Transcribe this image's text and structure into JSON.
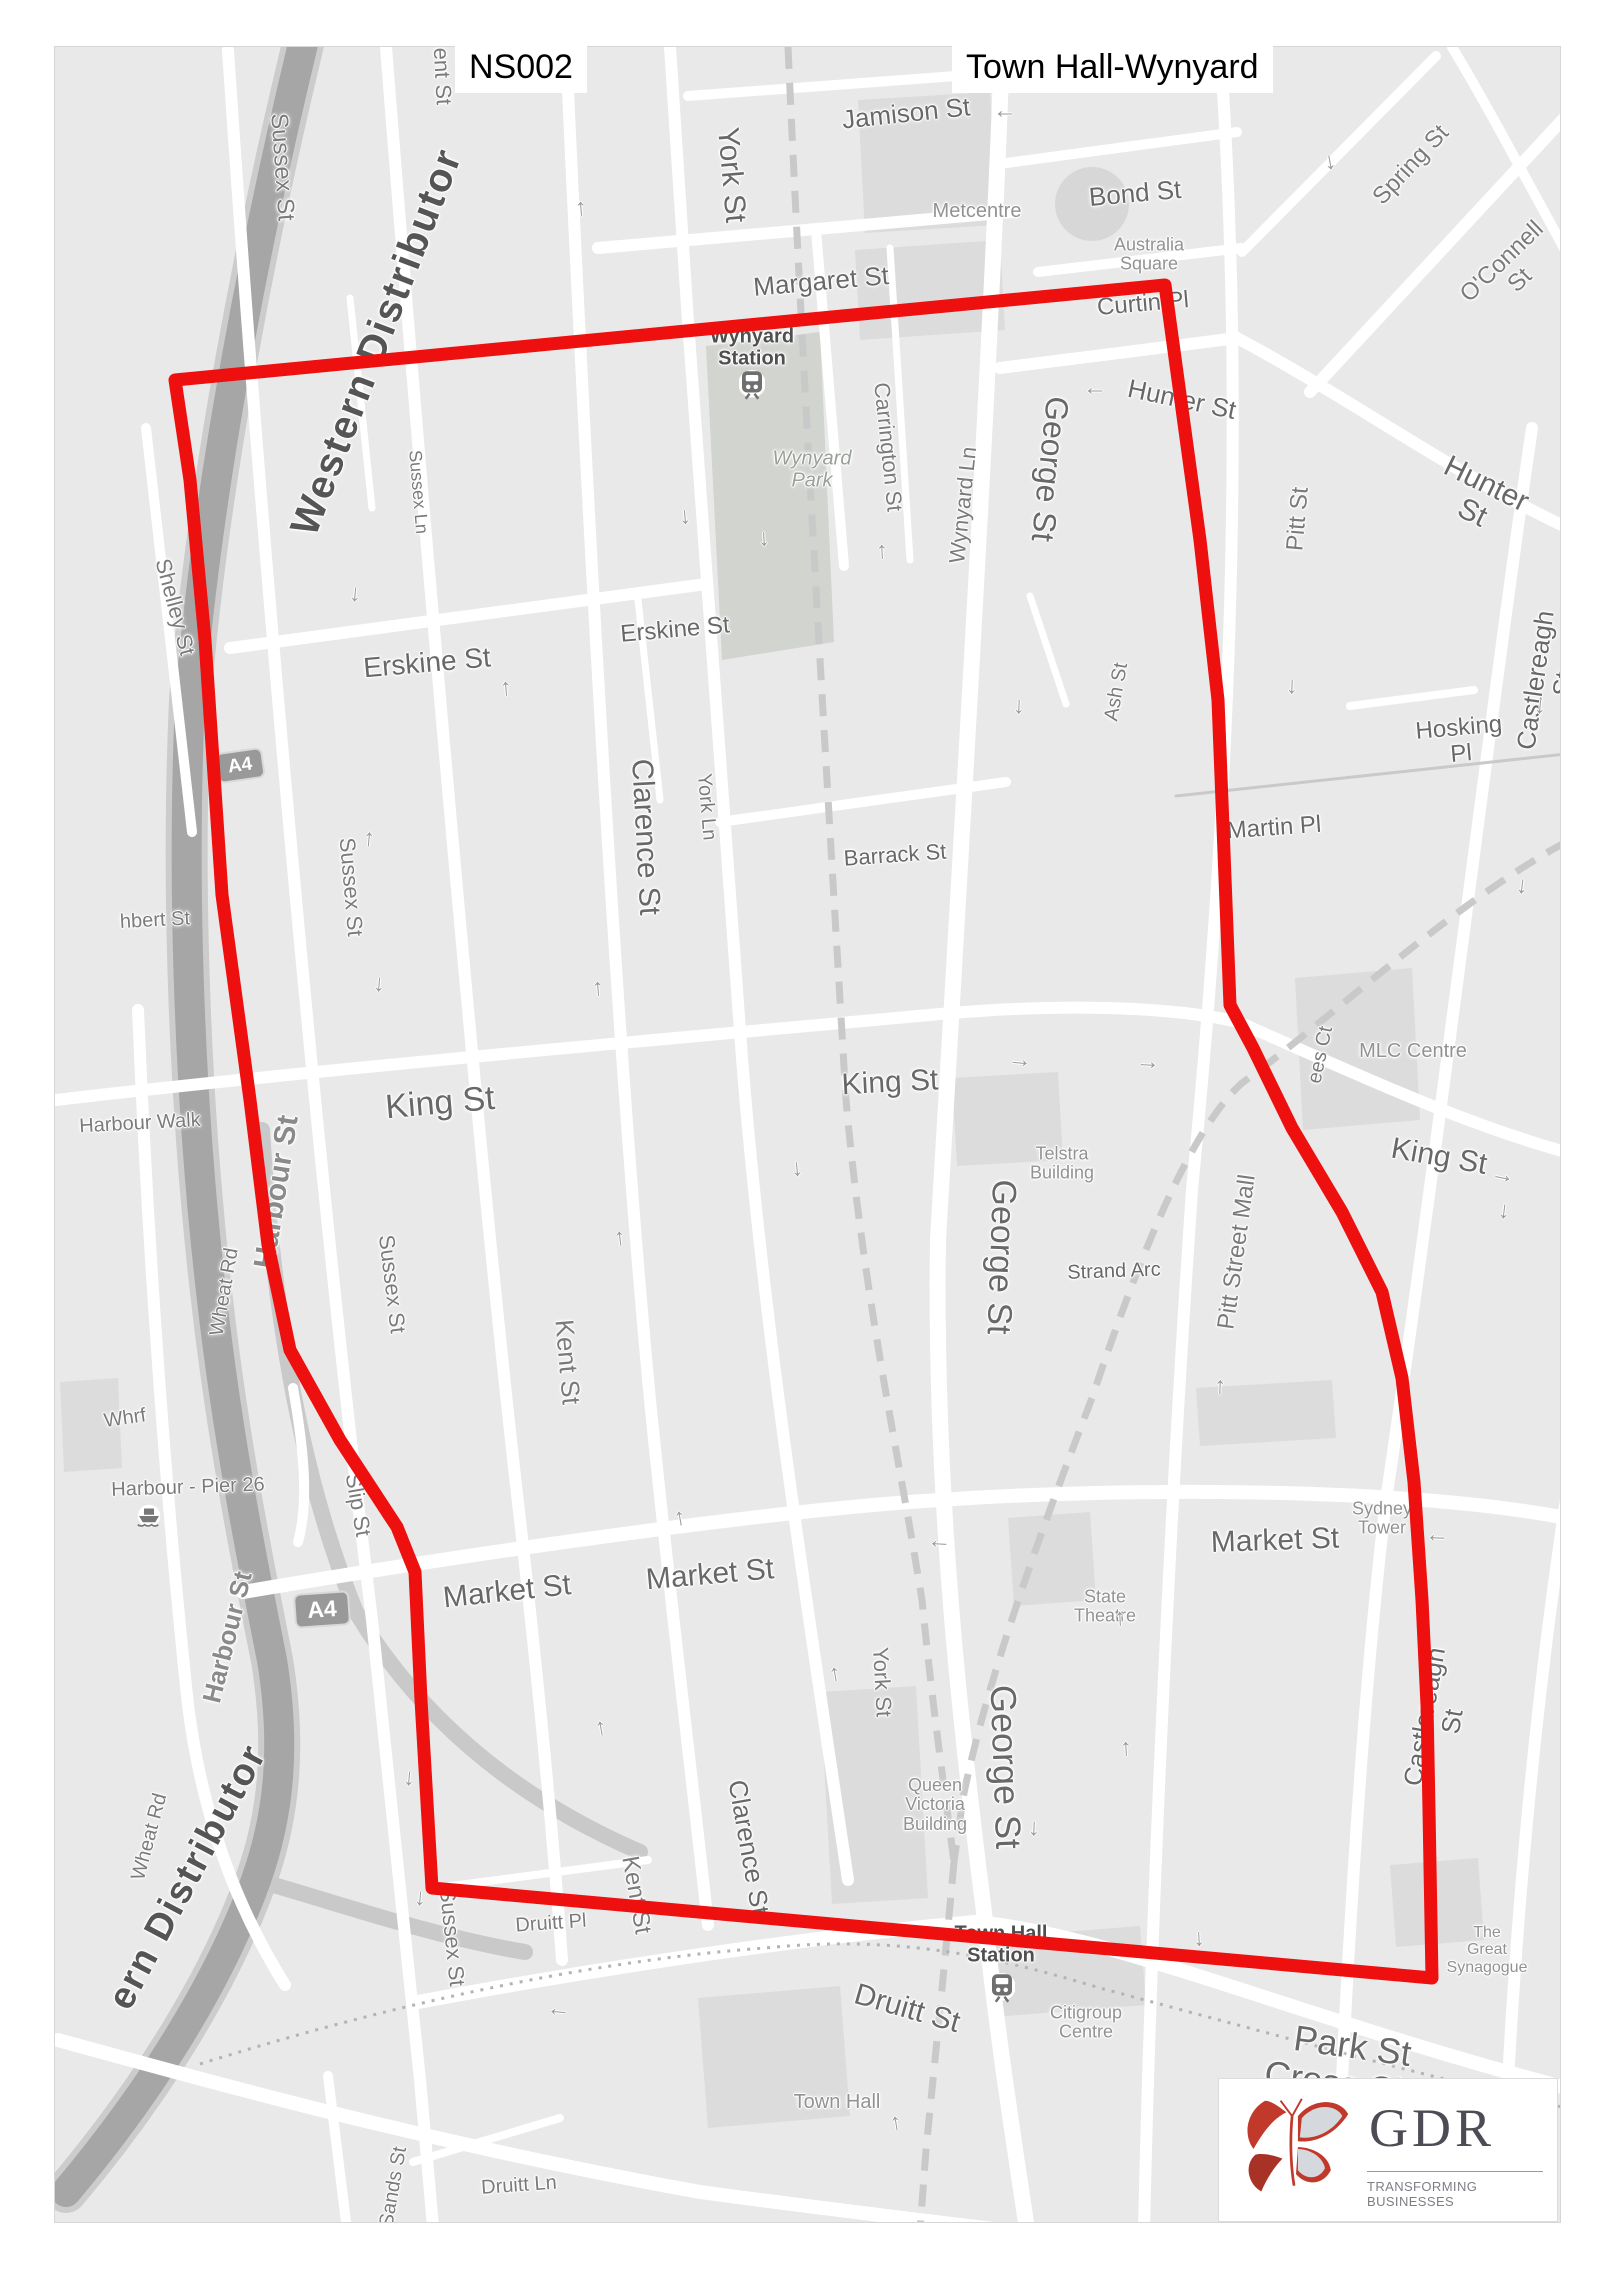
{
  "title": {
    "left": "NS002",
    "right": "Town Hall-Wynyard"
  },
  "logo": {
    "name": "GDR",
    "tagline": "TRANSFORMING BUSINESSES"
  },
  "red_zone": {
    "color": "#ee0f0f",
    "width": 13,
    "points": "175,380 1165,285 1200,540 1218,700 1230,1005 1253,1048 1292,1128 1342,1212 1382,1292 1402,1378 1414,1482 1422,1600 1427,1705 1429,1810 1432,1978 432,1888 421,1700 415,1572 397,1527 340,1440 290,1350 268,1245 250,1100 235,990 222,895 205,640 190,480"
  },
  "map": {
    "arrow_glyph": "→",
    "labels": [
      {
        "t": "Sussex St",
        "x": 227,
        "y": 120,
        "r": 86,
        "s": 24,
        "c": "st"
      },
      {
        "t": "Kent St",
        "x": 387,
        "y": 22,
        "r": 87,
        "s": 22,
        "c": "st"
      },
      {
        "t": "York St",
        "x": 676,
        "y": 128,
        "r": 85,
        "s": 30,
        "c": "st2"
      },
      {
        "t": "Jamison St",
        "x": 851,
        "y": 66,
        "r": -6,
        "s": 26,
        "c": "st2"
      },
      {
        "t": "Bond St",
        "x": 1080,
        "y": 146,
        "r": -5,
        "s": 26,
        "c": "st2"
      },
      {
        "t": "Spring St",
        "x": 1356,
        "y": 118,
        "r": -47,
        "s": 24,
        "c": "st"
      },
      {
        "t": "O'Connell St",
        "x": 1456,
        "y": 224,
        "r": -44,
        "s": 24,
        "c": "st"
      },
      {
        "t": "Metcentre",
        "x": 922,
        "y": 165,
        "r": 0,
        "s": 20,
        "c": "bld"
      },
      {
        "t": "Australia\nSquare",
        "x": 1094,
        "y": 208,
        "r": 0,
        "s": 18,
        "c": "bld"
      },
      {
        "t": "Margaret St",
        "x": 766,
        "y": 234,
        "r": -5,
        "s": 26,
        "c": "st2"
      },
      {
        "t": "Curtin Pl",
        "x": 1088,
        "y": 257,
        "r": -5,
        "s": 24,
        "c": "st2"
      },
      {
        "t": "Wynyard\nStation",
        "x": 697,
        "y": 301,
        "r": 0,
        "s": 20,
        "c": "sta"
      },
      {
        "t": "Hunter St",
        "x": 1127,
        "y": 352,
        "r": 12,
        "s": 26,
        "c": "st2"
      },
      {
        "t": "Hunter St",
        "x": 1424,
        "y": 452,
        "r": 26,
        "s": 30,
        "c": "st2"
      },
      {
        "t": "Carrington St",
        "x": 833,
        "y": 400,
        "r": 84,
        "s": 22,
        "c": "st"
      },
      {
        "t": "Wynyard Ln",
        "x": 908,
        "y": 458,
        "r": -84,
        "s": 22,
        "c": "st"
      },
      {
        "t": "Wynyard\nPark",
        "x": 757,
        "y": 423,
        "r": 0,
        "s": 20,
        "c": "park"
      },
      {
        "t": "George St",
        "x": 995,
        "y": 422,
        "r": 96,
        "s": 32,
        "c": "st2"
      },
      {
        "t": "Pitt St",
        "x": 1243,
        "y": 472,
        "r": -85,
        "s": 24,
        "c": "st"
      },
      {
        "t": "Sussex Ln",
        "x": 363,
        "y": 445,
        "r": 85,
        "s": 18,
        "c": "st"
      },
      {
        "t": "Shelley St",
        "x": 120,
        "y": 560,
        "r": 75,
        "s": 22,
        "c": "st"
      },
      {
        "t": "Erskine St",
        "x": 372,
        "y": 616,
        "r": -5,
        "s": 28,
        "c": "st2"
      },
      {
        "t": "Erskine St",
        "x": 620,
        "y": 583,
        "r": -5,
        "s": 24,
        "c": "st2"
      },
      {
        "t": "Ash St",
        "x": 1062,
        "y": 645,
        "r": -80,
        "s": 20,
        "c": "st"
      },
      {
        "t": "Hosking Pl",
        "x": 1405,
        "y": 694,
        "r": -5,
        "s": 24,
        "c": "st2"
      },
      {
        "t": "Castlereagh St",
        "x": 1494,
        "y": 635,
        "r": -82,
        "s": 26,
        "c": "st2"
      },
      {
        "t": "Martin Pl",
        "x": 1219,
        "y": 781,
        "r": -4,
        "s": 24,
        "c": "st2"
      },
      {
        "t": "Mar\nS",
        "x": 1553,
        "y": 786,
        "r": 0,
        "s": 20,
        "c": "st2"
      },
      {
        "t": "Western Distributor",
        "x": 322,
        "y": 295,
        "r": -69,
        "s": 40,
        "c": "mwy"
      },
      {
        "t": "hbert St",
        "x": 100,
        "y": 874,
        "r": -3,
        "s": 20,
        "c": "st"
      },
      {
        "t": "Sussex St",
        "x": 296,
        "y": 840,
        "r": 85,
        "s": 22,
        "c": "st"
      },
      {
        "t": "Clarence St",
        "x": 590,
        "y": 790,
        "r": 87,
        "s": 30,
        "c": "st2"
      },
      {
        "t": "York Ln",
        "x": 651,
        "y": 760,
        "r": 85,
        "s": 20,
        "c": "st"
      },
      {
        "t": "Barrack St",
        "x": 840,
        "y": 808,
        "r": -4,
        "s": 22,
        "c": "st2"
      },
      {
        "t": "King St",
        "x": 385,
        "y": 1056,
        "r": -5,
        "s": 34,
        "c": "st2"
      },
      {
        "t": "King St",
        "x": 835,
        "y": 1036,
        "r": -3,
        "s": 30,
        "c": "st2"
      },
      {
        "t": "King St",
        "x": 1384,
        "y": 1110,
        "r": 10,
        "s": 30,
        "c": "st2"
      },
      {
        "t": "ees Ct",
        "x": 1266,
        "y": 1008,
        "r": -78,
        "s": 20,
        "c": "st"
      },
      {
        "t": "MLC Centre",
        "x": 1358,
        "y": 1005,
        "r": 0,
        "s": 20,
        "c": "bld"
      },
      {
        "t": "Harbour Walk",
        "x": 85,
        "y": 1077,
        "r": -3,
        "s": 20,
        "c": "st"
      },
      {
        "t": "Telstra\nBuilding",
        "x": 1007,
        "y": 1117,
        "r": 0,
        "s": 18,
        "c": "bld"
      },
      {
        "t": "Pitt Street Mall",
        "x": 1182,
        "y": 1205,
        "r": -82,
        "s": 24,
        "c": "st"
      },
      {
        "t": "Strand Arc",
        "x": 1059,
        "y": 1225,
        "r": -2,
        "s": 20,
        "c": "st2"
      },
      {
        "t": "George St",
        "x": 946,
        "y": 1210,
        "r": 92,
        "s": 34,
        "c": "st2"
      },
      {
        "t": "Wheat Rd",
        "x": 170,
        "y": 1245,
        "r": -80,
        "s": 20,
        "c": "st"
      },
      {
        "t": "Harbour St",
        "x": 222,
        "y": 1145,
        "r": -81,
        "s": 30,
        "c": "sthalo"
      },
      {
        "t": "Kent St",
        "x": 513,
        "y": 1315,
        "r": 85,
        "s": 26,
        "c": "st"
      },
      {
        "t": "Sussex St",
        "x": 337,
        "y": 1237,
        "r": 83,
        "s": 22,
        "c": "st"
      },
      {
        "t": "Whrf",
        "x": 70,
        "y": 1372,
        "r": -8,
        "s": 20,
        "c": "st"
      },
      {
        "t": "Harbour - Pier 26",
        "x": 133,
        "y": 1441,
        "r": -2,
        "s": 20,
        "c": "st"
      },
      {
        "t": "Slip St",
        "x": 303,
        "y": 1458,
        "r": 80,
        "s": 22,
        "c": "st"
      },
      {
        "t": "Market St",
        "x": 452,
        "y": 1545,
        "r": -6,
        "s": 30,
        "c": "st2"
      },
      {
        "t": "Market St",
        "x": 655,
        "y": 1528,
        "r": -5,
        "s": 30,
        "c": "st2"
      },
      {
        "t": "Market St",
        "x": 1220,
        "y": 1494,
        "r": -2,
        "s": 30,
        "c": "st2"
      },
      {
        "t": "Sydney\nTower",
        "x": 1327,
        "y": 1472,
        "r": 0,
        "s": 18,
        "c": "bld"
      },
      {
        "t": "St James\nStation",
        "x": 1542,
        "y": 1450,
        "r": 0,
        "s": 18,
        "c": "sta"
      },
      {
        "t": "State\nTheatre",
        "x": 1050,
        "y": 1560,
        "r": 0,
        "s": 18,
        "c": "bld"
      },
      {
        "t": "Castlereagh St",
        "x": 1383,
        "y": 1672,
        "r": -80,
        "s": 26,
        "c": "st2"
      },
      {
        "t": "Harbour St",
        "x": 172,
        "y": 1590,
        "r": -76,
        "s": 26,
        "c": "sthalo"
      },
      {
        "t": "Wheat Rd",
        "x": 95,
        "y": 1790,
        "r": -75,
        "s": 20,
        "c": "st"
      },
      {
        "t": "ern Distributor",
        "x": 133,
        "y": 1830,
        "r": -62,
        "s": 38,
        "c": "mwy"
      },
      {
        "t": "York St",
        "x": 827,
        "y": 1635,
        "r": 87,
        "s": 22,
        "c": "st"
      },
      {
        "t": "George St",
        "x": 950,
        "y": 1720,
        "r": 88,
        "s": 36,
        "c": "st2"
      },
      {
        "t": "Queen\nVictoria\nBuilding",
        "x": 880,
        "y": 1758,
        "r": 0,
        "s": 18,
        "c": "bld"
      },
      {
        "t": "Clarence St",
        "x": 694,
        "y": 1800,
        "r": 80,
        "s": 26,
        "c": "st2"
      },
      {
        "t": "Kent St",
        "x": 581,
        "y": 1848,
        "r": 80,
        "s": 24,
        "c": "st"
      },
      {
        "t": "Sussex St",
        "x": 397,
        "y": 1890,
        "r": 84,
        "s": 22,
        "c": "st"
      },
      {
        "t": "Druitt Pl",
        "x": 496,
        "y": 1877,
        "r": -4,
        "s": 20,
        "c": "st"
      },
      {
        "t": "Town Hall\nStation",
        "x": 946,
        "y": 1898,
        "r": 0,
        "s": 20,
        "c": "sta"
      },
      {
        "t": "Druitt St",
        "x": 852,
        "y": 1962,
        "r": 16,
        "s": 30,
        "c": "st2"
      },
      {
        "t": "Citigroup\nCentre",
        "x": 1031,
        "y": 1976,
        "r": 0,
        "s": 18,
        "c": "bld"
      },
      {
        "t": "Park St Cross City Tunl",
        "x": 1292,
        "y": 2038,
        "r": 8,
        "s": 36,
        "c": "st2"
      },
      {
        "t": "The\nGreat\nSynagogue",
        "x": 1432,
        "y": 1903,
        "r": 0,
        "s": 16,
        "c": "bld"
      },
      {
        "t": "Town Hall",
        "x": 782,
        "y": 2056,
        "r": 0,
        "s": 20,
        "c": "bld"
      },
      {
        "t": "Druitt Ln",
        "x": 464,
        "y": 2139,
        "r": -4,
        "s": 20,
        "c": "st"
      },
      {
        "t": "Sands St",
        "x": 339,
        "y": 2140,
        "r": -80,
        "s": 20,
        "c": "st"
      },
      {
        "t": "St Andrew's\nCathedral",
        "x": 822,
        "y": 2208,
        "r": 0,
        "s": 18,
        "c": "bld"
      },
      {
        "t": "Cross City Tunl",
        "x": 360,
        "y": 2228,
        "r": 3,
        "s": 40,
        "c": "st2"
      },
      {
        "t": "St",
        "x": 1147,
        "y": 2196,
        "r": 85,
        "s": 20,
        "c": "st"
      }
    ],
    "arrows": [
      [
        950,
        70,
        180
      ],
      [
        523,
        162,
        -95
      ],
      [
        1278,
        115,
        80
      ],
      [
        1520,
        180,
        130
      ],
      [
        633,
        470,
        85
      ],
      [
        824,
        505,
        -93
      ],
      [
        712,
        492,
        87
      ],
      [
        448,
        642,
        -95
      ],
      [
        967,
        660,
        92
      ],
      [
        1488,
        660,
        95
      ],
      [
        1470,
        840,
        97
      ],
      [
        1040,
        347,
        180
      ],
      [
        303,
        548,
        95
      ],
      [
        311,
        792,
        -85
      ],
      [
        327,
        938,
        95
      ],
      [
        540,
        942,
        -95
      ],
      [
        562,
        1192,
        -97
      ],
      [
        745,
        1122,
        85
      ],
      [
        1240,
        640,
        92
      ],
      [
        1452,
        1165,
        97
      ],
      [
        1162,
        1340,
        -88
      ],
      [
        622,
        1472,
        -100
      ],
      [
        777,
        1628,
        -100
      ],
      [
        543,
        1682,
        -100
      ],
      [
        357,
        1732,
        95
      ],
      [
        368,
        1852,
        95
      ],
      [
        1062,
        1572,
        -93
      ],
      [
        1068,
        1702,
        -93
      ],
      [
        1147,
        1892,
        87
      ],
      [
        982,
        1782,
        92
      ],
      [
        838,
        2077,
        -100
      ],
      [
        1538,
        1982,
        -100
      ],
      [
        965,
        1013,
        5
      ],
      [
        1093,
        1015,
        3
      ],
      [
        884,
        1500,
        183
      ],
      [
        1382,
        1494,
        182
      ],
      [
        503,
        1968,
        185
      ],
      [
        1448,
        1128,
        12
      ]
    ],
    "badges": [
      {
        "text": "A4",
        "x": 185,
        "y": 718,
        "w": 44,
        "h": 27,
        "r": -8
      },
      {
        "text": "A4",
        "x": 267,
        "y": 1562,
        "w": 52,
        "h": 31,
        "r": -4
      }
    ],
    "stations": [
      [
        697,
        338
      ],
      [
        947,
        1941
      ],
      [
        1546,
        1494
      ]
    ],
    "ferry": [
      94,
      1469
    ]
  }
}
